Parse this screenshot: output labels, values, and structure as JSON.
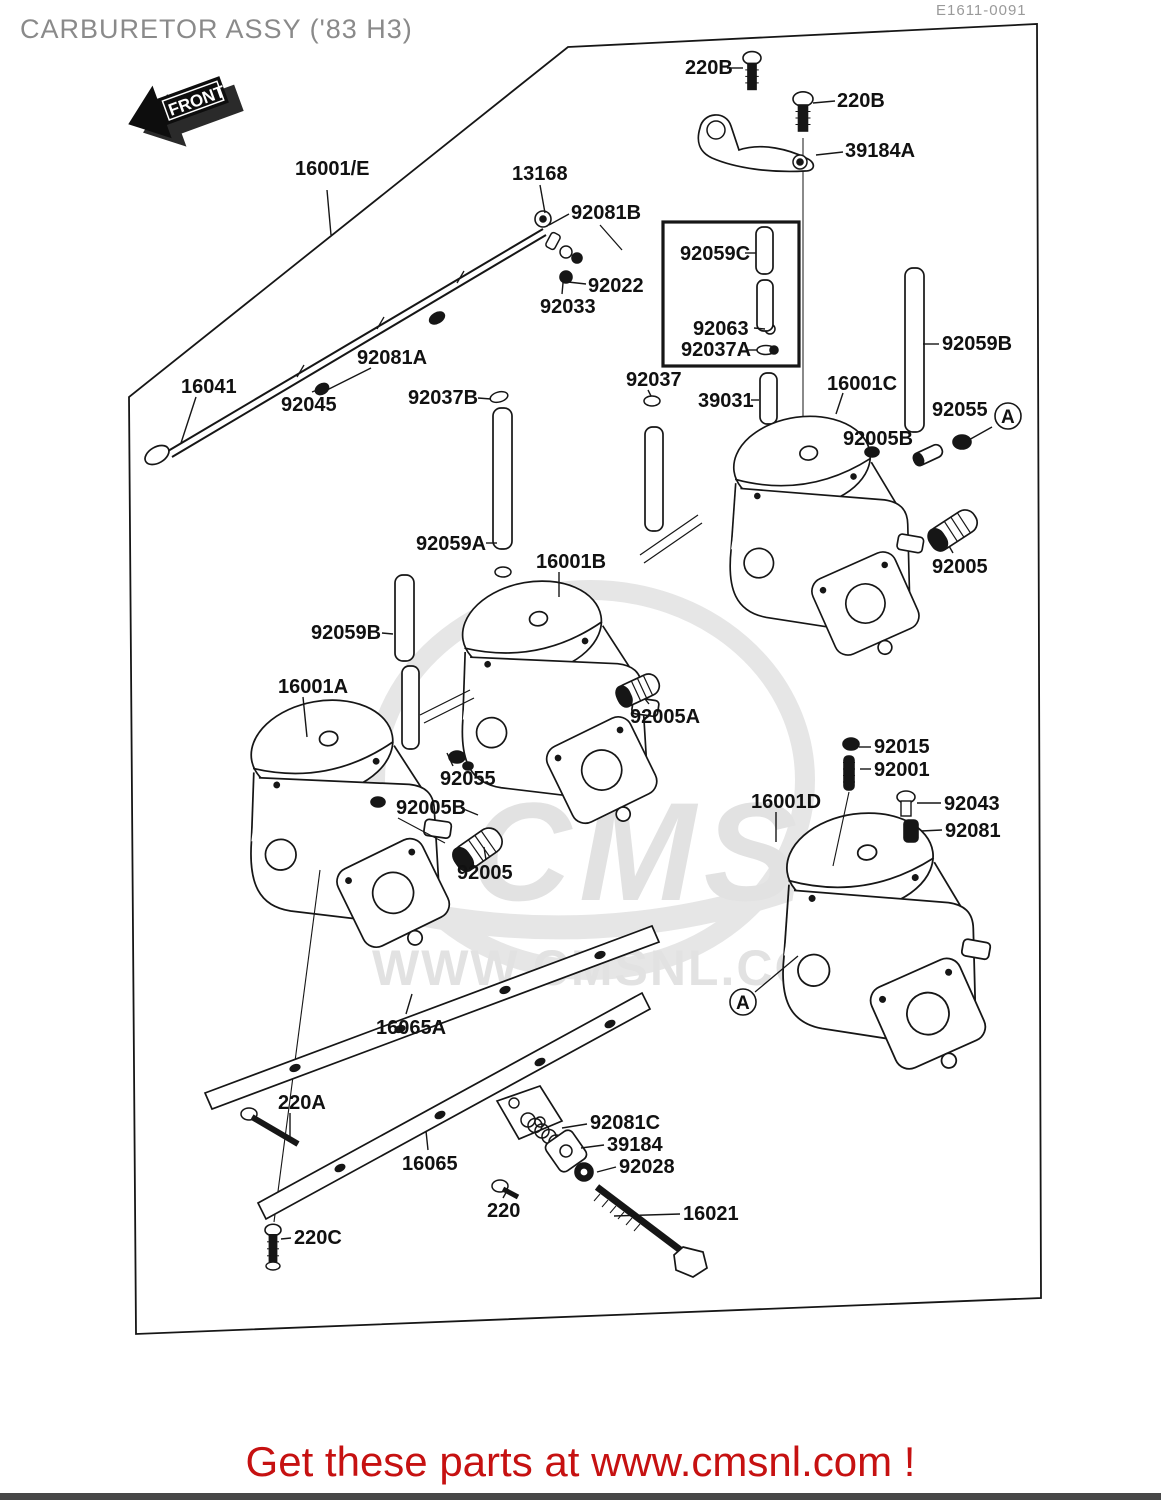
{
  "page": {
    "title": "CARBURETOR ASSY ('83 H3)",
    "doc_id": "E1611-0091",
    "front_label": "FRONT",
    "footer": "Get these parts at www.cmsnl.com !",
    "watermark_big": "CMS",
    "watermark_url": "WWW.CMSNL.COM"
  },
  "colors": {
    "line": "#161616",
    "title_gray": "#8a8a8a",
    "footer_red": "#c61111",
    "watermark_gray": "#e2e2e2"
  },
  "diagram": {
    "labels": [
      {
        "text": "16001/E",
        "x": 295,
        "y": 158,
        "leader": [
          [
            327,
            190
          ],
          [
            331,
            235
          ]
        ]
      },
      {
        "text": "13168",
        "x": 512,
        "y": 163,
        "leader": [
          [
            540,
            185
          ],
          [
            545,
            213
          ]
        ]
      },
      {
        "text": "92081B",
        "x": 571,
        "y": 202,
        "leader": [
          [
            569,
            214
          ],
          [
            549,
            225
          ]
        ]
      },
      {
        "text": "92022",
        "x": 588,
        "y": 275,
        "leader": [
          [
            586,
            284
          ],
          [
            568,
            282
          ]
        ]
      },
      {
        "text": "92033",
        "x": 540,
        "y": 296,
        "leader": [
          [
            562,
            294
          ],
          [
            564,
            272
          ]
        ]
      },
      {
        "text": "92081A",
        "x": 357,
        "y": 347,
        "leader": [
          [
            371,
            368
          ],
          [
            325,
            391
          ]
        ]
      },
      {
        "text": "16041",
        "x": 181,
        "y": 376,
        "leader": [
          [
            196,
            397
          ],
          [
            181,
            443
          ]
        ]
      },
      {
        "text": "92045",
        "x": 281,
        "y": 394,
        "leader": [
          [
            312,
            392
          ],
          [
            320,
            389
          ]
        ]
      },
      {
        "text": "92037B",
        "x": 408,
        "y": 387,
        "leader": [
          [
            478,
            398
          ],
          [
            491,
            399
          ]
        ]
      },
      {
        "text": "220B",
        "x": 685,
        "y": 57,
        "leader": [
          [
            727,
            68
          ],
          [
            743,
            68
          ]
        ]
      },
      {
        "text": "220B",
        "x": 837,
        "y": 90,
        "leader": [
          [
            835,
            101
          ],
          [
            813,
            103
          ]
        ]
      },
      {
        "text": "39184A",
        "x": 845,
        "y": 140,
        "leader": [
          [
            843,
            152
          ],
          [
            816,
            155
          ]
        ]
      },
      {
        "text": "92059C",
        "x": 680,
        "y": 243,
        "leader": [
          [
            745,
            253
          ],
          [
            756,
            253
          ]
        ]
      },
      {
        "text": "92063",
        "x": 693,
        "y": 318,
        "leader": [
          [
            754,
            328
          ],
          [
            765,
            329
          ]
        ]
      },
      {
        "text": "92037A",
        "x": 681,
        "y": 339,
        "leader": [
          [
            748,
            350
          ],
          [
            757,
            350
          ]
        ]
      },
      {
        "text": "92037",
        "x": 626,
        "y": 369,
        "leader": [
          [
            648,
            390
          ],
          [
            651,
            396
          ]
        ]
      },
      {
        "text": "39031",
        "x": 698,
        "y": 390,
        "leader": [
          [
            751,
            400
          ],
          [
            759,
            400
          ]
        ]
      },
      {
        "text": "16001C",
        "x": 827,
        "y": 373,
        "leader": [
          [
            843,
            393
          ],
          [
            836,
            414
          ]
        ]
      },
      {
        "text": "92059B",
        "x": 942,
        "y": 333,
        "leader": [
          [
            939,
            344
          ],
          [
            923,
            344
          ]
        ]
      },
      {
        "text": "92055",
        "x": 932,
        "y": 399,
        "leader": [
          [
            992,
            427
          ],
          [
            967,
            441
          ]
        ]
      },
      {
        "text": "92005B",
        "x": 843,
        "y": 428,
        "leader": [
          [
            870,
            447
          ],
          [
            874,
            453
          ]
        ]
      },
      {
        "text": "92005",
        "x": 932,
        "y": 556,
        "leader": [
          [
            953,
            553
          ],
          [
            949,
            546
          ]
        ]
      },
      {
        "text": "92059A",
        "x": 416,
        "y": 533,
        "leader": [
          [
            486,
            543
          ],
          [
            497,
            543
          ]
        ]
      },
      {
        "text": "16001B",
        "x": 536,
        "y": 551,
        "leader": [
          [
            559,
            572
          ],
          [
            559,
            597
          ]
        ]
      },
      {
        "text": "92059B",
        "x": 311,
        "y": 622,
        "leader": [
          [
            382,
            633
          ],
          [
            393,
            634
          ]
        ]
      },
      {
        "text": "16001A",
        "x": 278,
        "y": 676,
        "leader": [
          [
            303,
            697
          ],
          [
            307,
            737
          ]
        ]
      },
      {
        "text": "92005A",
        "x": 630,
        "y": 706,
        "leader": [
          [
            649,
            704
          ],
          [
            645,
            699
          ]
        ]
      },
      {
        "text": "92055",
        "x": 440,
        "y": 768,
        "leader": [
          [
            453,
            766
          ],
          [
            447,
            753
          ]
        ]
      },
      {
        "text": "92005B",
        "x": 396,
        "y": 797,
        "leader": [
          [
            461,
            808
          ],
          [
            478,
            815
          ]
        ]
      },
      {
        "text": "92005",
        "x": 457,
        "y": 862,
        "leader": [
          [
            486,
            860
          ],
          [
            484,
            847
          ]
        ]
      },
      {
        "text": "92015",
        "x": 874,
        "y": 736,
        "leader": [
          [
            871,
            747
          ],
          [
            859,
            747
          ]
        ]
      },
      {
        "text": "92001",
        "x": 874,
        "y": 759,
        "leader": [
          [
            871,
            769
          ],
          [
            860,
            769
          ]
        ]
      },
      {
        "text": "16001D",
        "x": 751,
        "y": 791,
        "leader": [
          [
            776,
            812
          ],
          [
            776,
            842
          ]
        ]
      },
      {
        "text": "92043",
        "x": 944,
        "y": 793,
        "leader": [
          [
            941,
            803
          ],
          [
            917,
            803
          ]
        ]
      },
      {
        "text": "92081",
        "x": 945,
        "y": 820,
        "leader": [
          [
            942,
            830
          ],
          [
            921,
            831
          ]
        ]
      },
      {
        "text": "16065A",
        "x": 376,
        "y": 1017,
        "leader": [
          [
            406,
            1014
          ],
          [
            412,
            994
          ]
        ]
      },
      {
        "text": "220A",
        "x": 278,
        "y": 1092,
        "leader": [
          [
            290,
            1113
          ],
          [
            290,
            1138
          ]
        ]
      },
      {
        "text": "16065",
        "x": 402,
        "y": 1153,
        "leader": [
          [
            428,
            1150
          ],
          [
            426,
            1131
          ]
        ]
      },
      {
        "text": "92081C",
        "x": 590,
        "y": 1112,
        "leader": [
          [
            587,
            1124
          ],
          [
            562,
            1128
          ]
        ]
      },
      {
        "text": "39184",
        "x": 607,
        "y": 1134,
        "leader": [
          [
            604,
            1145
          ],
          [
            581,
            1148
          ]
        ]
      },
      {
        "text": "92028",
        "x": 619,
        "y": 1156,
        "leader": [
          [
            616,
            1167
          ],
          [
            597,
            1172
          ]
        ]
      },
      {
        "text": "220",
        "x": 487,
        "y": 1200,
        "leader": [
          [
            503,
            1198
          ],
          [
            508,
            1189
          ]
        ]
      },
      {
        "text": "16021",
        "x": 683,
        "y": 1203,
        "leader": [
          [
            680,
            1214
          ],
          [
            614,
            1216
          ]
        ]
      },
      {
        "text": "220C",
        "x": 294,
        "y": 1227,
        "leader": [
          [
            291,
            1238
          ],
          [
            281,
            1239
          ]
        ]
      }
    ],
    "callouts": [
      {
        "text": "A",
        "cx": 1008,
        "cy": 416,
        "r": 13
      },
      {
        "text": "A",
        "cx": 743,
        "cy": 1002,
        "r": 13
      }
    ]
  }
}
